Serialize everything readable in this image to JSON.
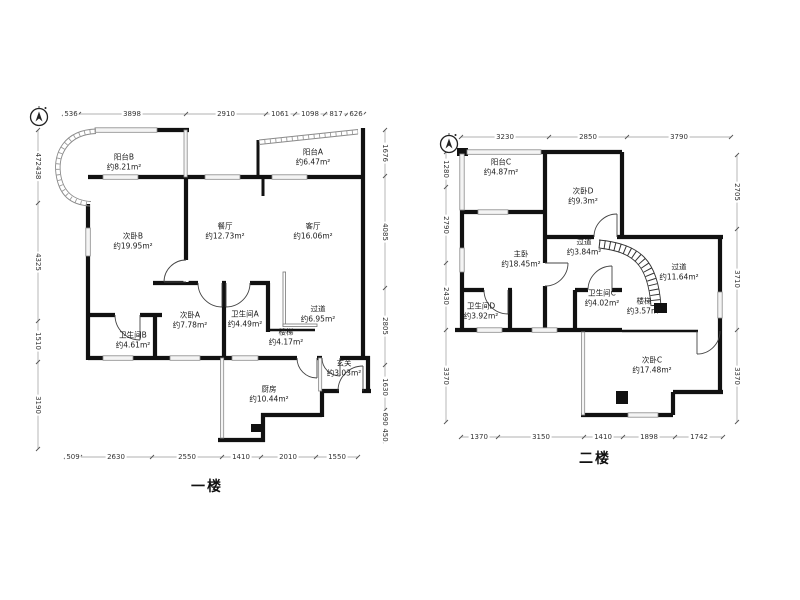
{
  "colors": {
    "wall": "#111111",
    "window_fill": "#f4f4f4",
    "window_stroke": "#8a8a8a",
    "dim_text": "#333333"
  },
  "floor1": {
    "title": "一楼",
    "rooms": {
      "balcony_b": {
        "name": "阳台B",
        "area": "约8.21m²"
      },
      "balcony_a": {
        "name": "阳台A",
        "area": "约6.47m²"
      },
      "bedroom_b": {
        "name": "次卧B",
        "area": "约19.95m²"
      },
      "dining": {
        "name": "餐厅",
        "area": "约12.73m²"
      },
      "living": {
        "name": "客厅",
        "area": "约16.06m²"
      },
      "bathroom_b": {
        "name": "卫生间B",
        "area": "约4.61m²"
      },
      "bedroom_a": {
        "name": "次卧A",
        "area": "约7.78m²"
      },
      "bathroom_a": {
        "name": "卫生间A",
        "area": "约4.49m²"
      },
      "stairs": {
        "name": "楼梯",
        "area": "约4.17m²"
      },
      "corridor": {
        "name": "过道",
        "area": "约6.95m²"
      },
      "kitchen": {
        "name": "厨房",
        "area": "约10.44m²"
      },
      "foyer": {
        "name": "玄关",
        "area": "约3.03m²"
      }
    },
    "dims": {
      "top": [
        "536",
        "3898",
        "2910",
        "1061",
        "1098",
        "817",
        "626"
      ],
      "bottom": [
        "509",
        "2630",
        "2550",
        "1410",
        "2010",
        "1550"
      ],
      "left": [
        "472438",
        "4325",
        "1510",
        "3190"
      ],
      "right": [
        "1676",
        "4085",
        "2805",
        "1630",
        "690",
        "450"
      ]
    }
  },
  "floor2": {
    "title": "二楼",
    "rooms": {
      "balcony_c": {
        "name": "阳台C",
        "area": "约4.87m²"
      },
      "bedroom_d": {
        "name": "次卧D",
        "area": "约9.3m²"
      },
      "master": {
        "name": "主卧",
        "area": "约18.45m²"
      },
      "corridor_small": {
        "name": "过道",
        "area": "约3.84m²"
      },
      "bathroom_d": {
        "name": "卫生间D",
        "area": "约3.92m²"
      },
      "bathroom_c": {
        "name": "卫生间C",
        "area": "约4.02m²"
      },
      "stairs": {
        "name": "楼梯",
        "area": "约3.57m²"
      },
      "corridor_large": {
        "name": "过道",
        "area": "约11.64m²"
      },
      "bedroom_c": {
        "name": "次卧C",
        "area": "约17.48m²"
      }
    },
    "dims": {
      "top": [
        "3230",
        "2850",
        "3790"
      ],
      "bottom": [
        "1370",
        "3150",
        "1410",
        "1898",
        "1742"
      ],
      "left": [
        "1280",
        "2790",
        "2430",
        "3370"
      ],
      "right": [
        "2705",
        "3710",
        "3370"
      ]
    }
  }
}
